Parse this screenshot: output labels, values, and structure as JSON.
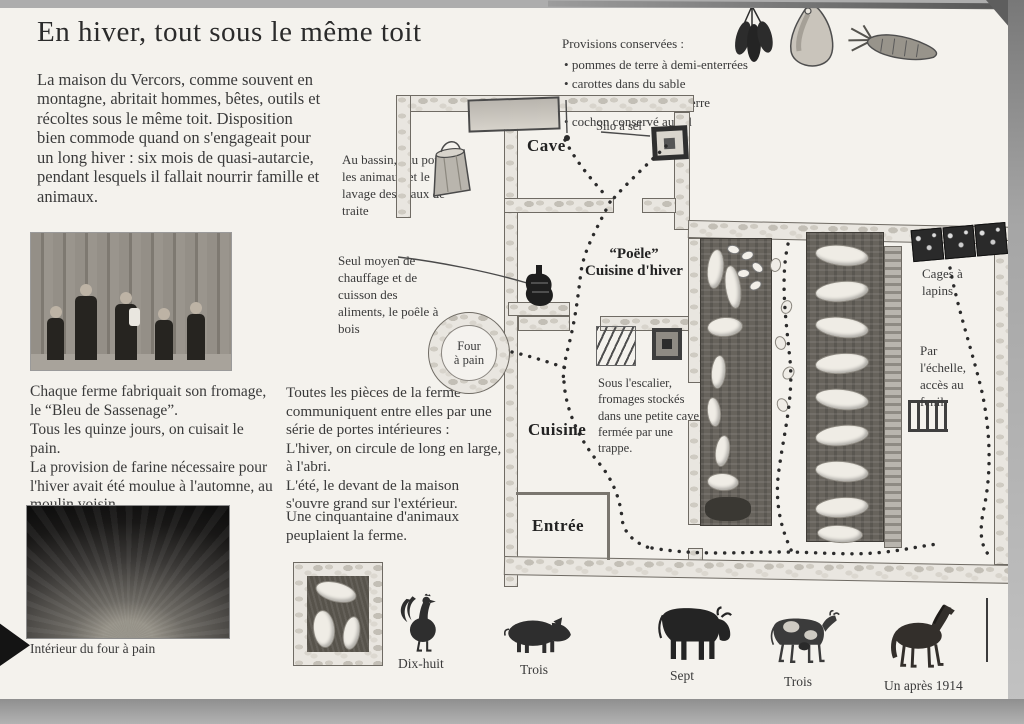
{
  "page": {
    "title": "En hiver, tout sous le même toit",
    "intro": "La maison du Vercors, comme souvent en montagne, abritait hommes, bêtes, outils et récoltes sous le même toit. Disposition bien commode quand on s'engageait pour un long hiver : six mois de quasi-autarcie, pendant lesquels il fallait nourrir famille et animaux.",
    "cheese_note": "Chaque ferme fabriquait son fromage, le “Bleu de Sassenage”.\nTous les quinze jours, on cuisait le pain.\nLa provision de farine nécessaire pour l'hiver avait été moulue à l'automne, au moulin voisin.",
    "oven_caption": "Intérieur du four à pain"
  },
  "provisions": {
    "title": "Provisions conservées :",
    "items": [
      "pommes de terre à demi-enterrées",
      "carottes dans du sable",
      "poireaux replantés en terre",
      "cochon conservé au sel"
    ]
  },
  "annotations": {
    "bassin": "Au bassin, eau pour les animaux et le lavage des seaux de traite",
    "stove": "Seul moyen de chauffage et de cuisson des aliments, le poêle à bois",
    "rooms": "Toutes les pièces de la ferme communiquent entre elles par une série de portes intérieures :\nL'hiver, on circule de long en large, à l'abri.\nL'été, le devant de la maison s'ouvre grand sur l'extérieur.",
    "animals_count": "Une cinquantaine d'animaux peuplaient la ferme.",
    "under_stairs": "Sous l'escalier, fromages stockés dans une petite cave fermée par une trappe.",
    "rabbit_cages": "Cages à lapins",
    "ladder": "Par l'échelle, accès au fenil"
  },
  "plan_labels": {
    "cave": "Cave",
    "silo": "Silo à sel",
    "stove_room_line1": "“Poële”",
    "stove_room_line2": "Cuisine d'hiver",
    "oven_line1": "Four",
    "oven_line2": "à pain",
    "kitchen": "Cuisine",
    "entrance": "Entrée"
  },
  "animals": [
    {
      "name": "rooster",
      "label": "Dix-huit"
    },
    {
      "name": "pig",
      "label": "Trois"
    },
    {
      "name": "bull",
      "label": "Sept"
    },
    {
      "name": "cow",
      "label": "Trois"
    },
    {
      "name": "horse",
      "label": "Un après 1914"
    }
  ],
  "colors": {
    "paper": "#f4f2ed",
    "ink": "#3a3a3a",
    "stone": "#e9e6e0",
    "stall_dark": "#67635c"
  }
}
